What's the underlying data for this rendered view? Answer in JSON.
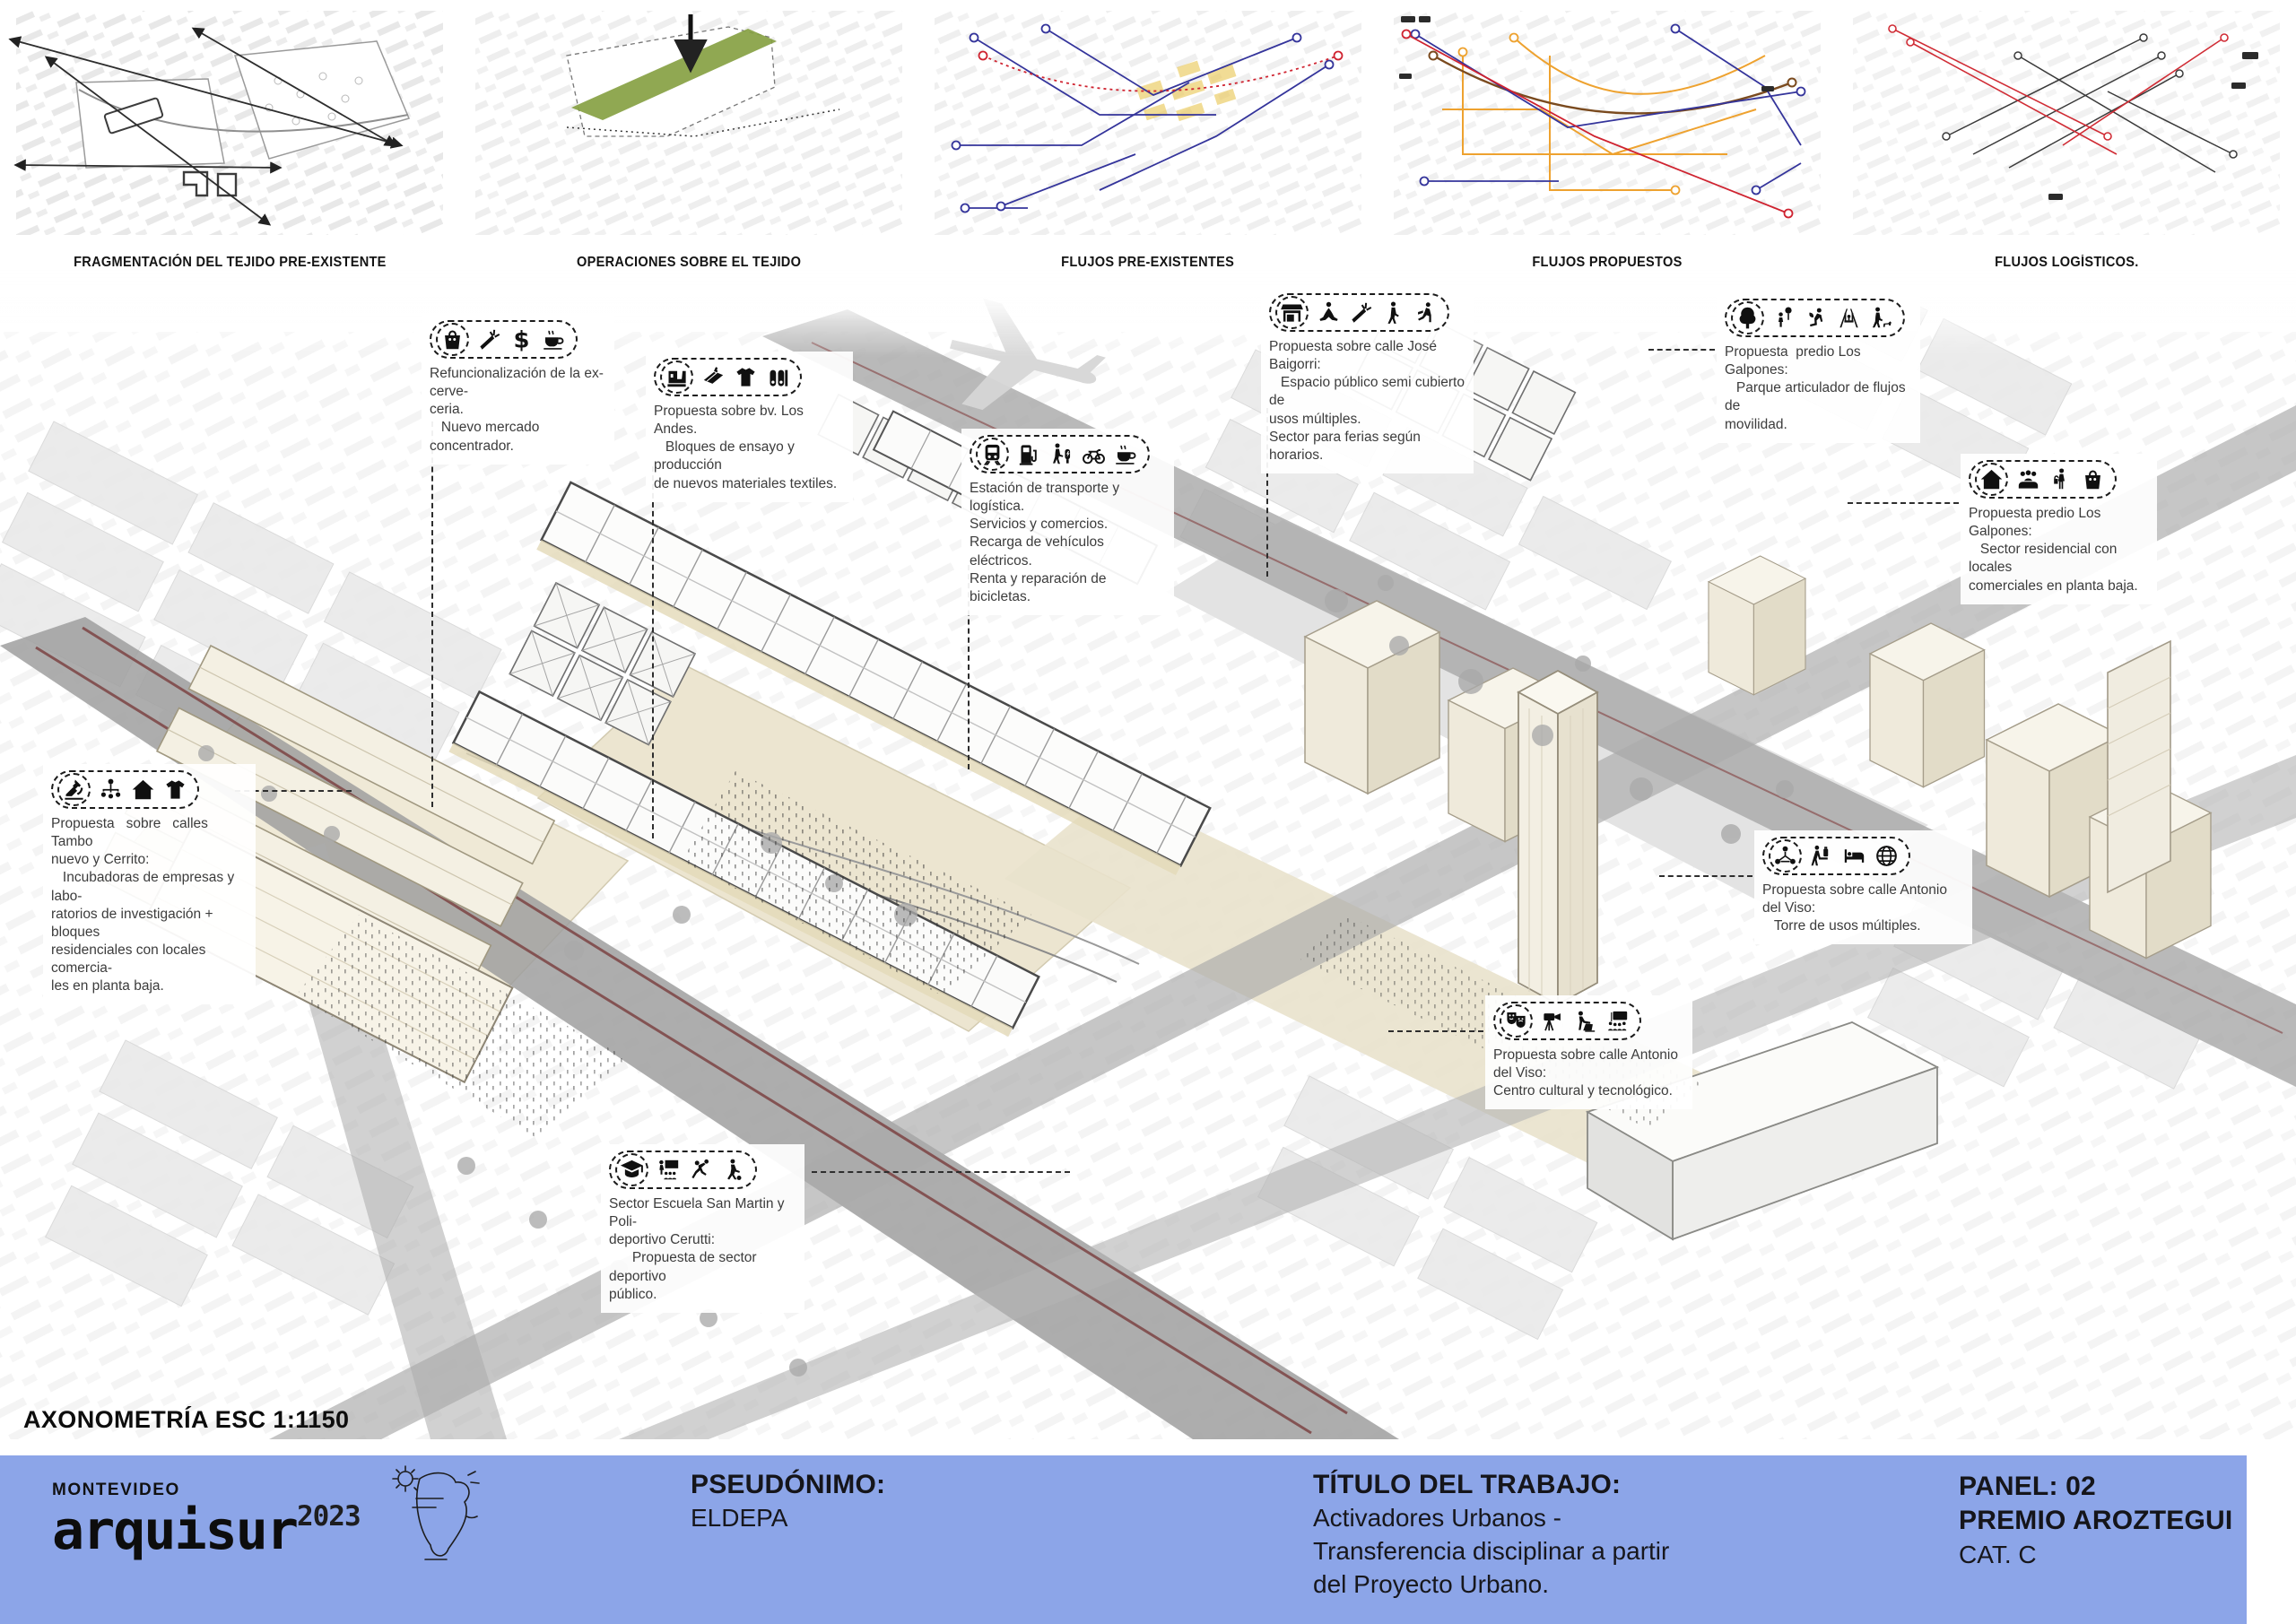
{
  "panel": {
    "axon_label": "AXONOMETRÍA ESC 1:1150"
  },
  "diagrams": [
    {
      "label": "FRAGMENTACIÓN DEL TEJIDO PRE-EXISTENTE"
    },
    {
      "label": "OPERACIONES SOBRE EL TEJIDO"
    },
    {
      "label": "FLUJOS PRE-EXISTENTES"
    },
    {
      "label": "FLUJOS PROPUESTOS"
    },
    {
      "label": "FLUJOS LOGÍSTICOS."
    }
  ],
  "callouts": [
    {
      "id": "c1",
      "icons": [
        "grocery-bag-icon",
        "carrot-icon",
        "dollar-icon",
        "coffee-icon"
      ],
      "lines": [
        "Refuncionalización de la ex-cerve-",
        "ceria.",
        "   Nuevo mercado concentrador."
      ]
    },
    {
      "id": "c2",
      "icons": [
        "sewing-machine-icon",
        "fabric-icon",
        "tshirt-icon",
        "fabric-rolls-icon"
      ],
      "lines": [
        "Propuesta sobre bv. Los Andes.",
        "   Bloques de ensayo y producción",
        "de nuevos materiales textiles."
      ]
    },
    {
      "id": "c3",
      "icons": [
        "train-icon",
        "ev-charger-icon",
        "charging-post-icon",
        "bicycle-icon",
        "coffee-icon"
      ],
      "lines": [
        "Estación de transporte y logística.",
        "Servicios y comercios.",
        "Recarga de vehículos eléctricos.",
        "Renta y reparación de bicicletas."
      ]
    },
    {
      "id": "c4",
      "icons": [
        "market-stall-icon",
        "yoga-icon",
        "carrot-icon",
        "pedestrian-icon",
        "reading-icon"
      ],
      "lines": [
        "Propuesta sobre calle José Baigorri:",
        "   Espacio público semi cubierto de",
        "usos múltiples.",
        "Sector para ferias según horarios."
      ]
    },
    {
      "id": "c5",
      "icons": [
        "tree-icon",
        "child-balloon-icon",
        "gardening-icon",
        "swing-icon",
        "dog-walking-icon"
      ],
      "lines": [
        "Propuesta  predio Los Galpones:",
        "   Parque articulador de flujos de",
        "movilidad."
      ]
    },
    {
      "id": "c6",
      "icons": [
        "house-icon",
        "community-icon",
        "shopper-icon",
        "grocery-bag-icon"
      ],
      "lines": [
        "Propuesta predio Los Galpones:",
        "   Sector residencial con locales",
        "comerciales en planta baja."
      ]
    },
    {
      "id": "c7",
      "icons": [
        "network-icon",
        "porter-icon",
        "hotel-bed-icon",
        "globe-icon"
      ],
      "lines": [
        "Propuesta sobre calle Antonio del Viso:",
        "   Torre de usos múltiples."
      ]
    },
    {
      "id": "c8",
      "icons": [
        "theater-masks-icon",
        "filming-icon",
        "laptop-icon",
        "presentation-icon"
      ],
      "lines": [
        "Propuesta sobre calle Antonio del Viso:",
        "Centro cultural y tecnológico."
      ]
    },
    {
      "id": "c9",
      "icons": [
        "graduation-cap-icon",
        "classroom-icon",
        "basketball-icon",
        "soccer-icon"
      ],
      "lines": [
        "Sector Escuela San Martin y Poli-",
        "deportivo Cerutti:",
        "      Propuesta de sector deportivo",
        "público."
      ]
    },
    {
      "id": "c10",
      "icons": [
        "microscope-icon",
        "org-chart-icon",
        "house-icon",
        "tshirt-icon"
      ],
      "lines": [
        "Propuesta   sobre   calles   Tambo",
        "nuevo y Cerrito:",
        "   Incubadoras de empresas y labo-",
        "ratorios de investigación +  bloques",
        "residenciales con locales comercia-",
        "les en planta baja."
      ]
    }
  ],
  "footer": {
    "brand": {
      "city": "MONTEVIDEO",
      "name": "arquisur",
      "year": "2023"
    },
    "pseudonym_label": "PSEUDÓNIMO:",
    "pseudonym_value": "ELDEPA",
    "title_label": "TÍTULO DEL TRABAJO:",
    "title_lines": [
      "Activadores Urbanos -",
      "Transferencia disciplinar a partir",
      "del Proyecto Urbano."
    ],
    "panel_label": "PANEL: 02",
    "award": "PREMIO AROZTEGUI",
    "category": "CAT. C"
  },
  "colors": {
    "footer_bar": "#8ca5e8",
    "flow_blue": "#34349b",
    "flow_red": "#cf2330",
    "flow_orange": "#eea22f",
    "flow_brown": "#7a4a1e",
    "operation_green": "#87a143"
  }
}
